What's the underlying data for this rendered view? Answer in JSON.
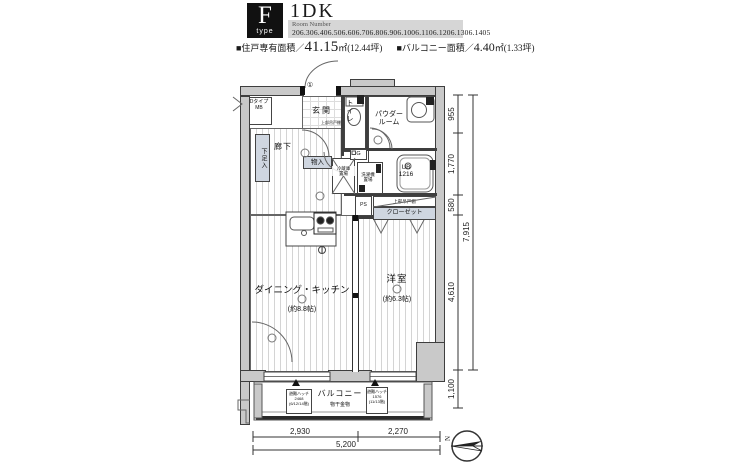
{
  "header": {
    "type_letter": "F",
    "type_word": "type",
    "plan_type": "1DK",
    "room_number_label": "Room Number",
    "room_numbers": "206.306.406.506.606.706.806.906.1006.1106.1206.1306.1405",
    "unit_area_label": "■住戸専有面積／",
    "unit_area_value": "41.15",
    "unit_area_suffix": "㎡(12.44坪)",
    "balcony_area_label": "■バルコニー面積／",
    "balcony_area_value": "4.40",
    "balcony_area_suffix": "㎡(1.33坪)"
  },
  "plan": {
    "meter_box_type": "Dタイプ",
    "meter_box": "MB",
    "entrance": "玄関",
    "toilet": "トイレ",
    "toilet_shelf": "上部吊戸棚",
    "powder1": "パウダー",
    "powder2": "ルーム",
    "shoe": "下足入",
    "hall": "廊下",
    "storage": "物入",
    "fridge1": "冷蔵庫",
    "fridge2": "置場",
    "washer1": "洗濯機",
    "washer2": "置場",
    "gas": "G",
    "ub1": "UB",
    "ub2": "1216",
    "ps": "PS",
    "shelf_strip": "上部吊戸棚",
    "closet": "クローゼット",
    "dk": "ダイニング・キッチン",
    "dk_size": "(約8.8帖)",
    "west": "洋室",
    "west_size": "(約6.3帖)",
    "balcony": "バルコニー",
    "drying": "物干金物",
    "hatch1_a": "避難ハッチ",
    "hatch1_b": "2468",
    "hatch1_c": "(6/12/14階)",
    "hatch2_a": "避難ハッチ",
    "hatch2_b": "1576",
    "hatch2_c": "(11/13階)",
    "note1": "①"
  },
  "dimensions": {
    "d955": "955",
    "d1770": "1,770",
    "d580": "580",
    "d4610": "4,610",
    "d1100": "1,100",
    "d7915": "7,915",
    "d2930": "2,930",
    "d2270": "2,270",
    "d5200": "5,200"
  },
  "compass": {
    "n": "N"
  },
  "colors": {
    "wall_fill": "#c9c9c9",
    "storage_fill": "#cfd6e0",
    "badge_bg": "#111111",
    "header_box_bg": "#d6d6d6"
  }
}
